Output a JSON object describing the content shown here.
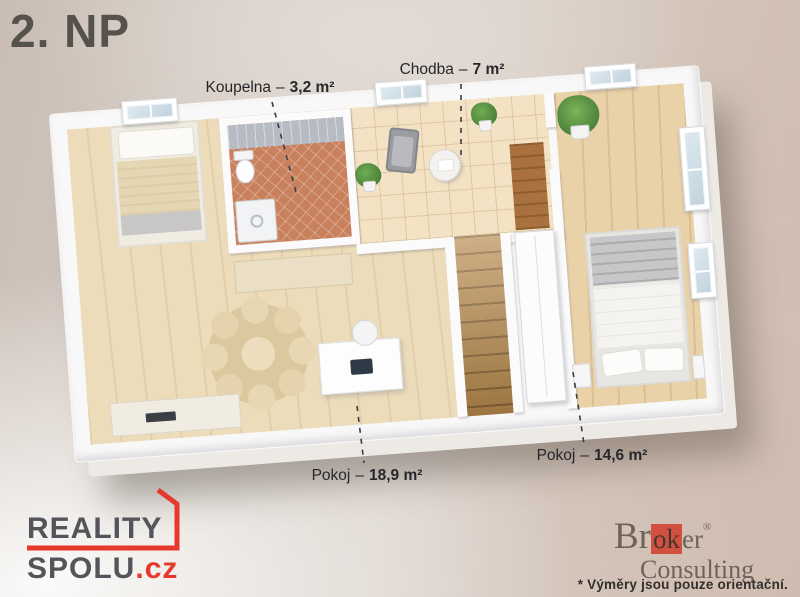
{
  "title": "2. NP",
  "rooms": [
    {
      "name": "Koupelna",
      "sep": "–",
      "area": "3,2 m²"
    },
    {
      "name": "Chodba",
      "sep": "–",
      "area": "7 m²"
    },
    {
      "name": "Pokoj",
      "sep": "–",
      "area": "18,9 m²"
    },
    {
      "name": "Pokoj",
      "sep": "–",
      "area": "14,6 m²"
    }
  ],
  "logos": {
    "reality_spolu": {
      "line1": "REALITY",
      "line2": "SPOLU",
      "tld": ".cz"
    },
    "broker_consulting": {
      "name_prefix": "Br",
      "name_accent": "ok",
      "name_suffix": "er",
      "registered": "®",
      "second_word": "Consulting"
    }
  },
  "disclaimer": "* Výměry jsou pouze orientační.",
  "colors": {
    "accent_red": "#e6382b",
    "logo_gray": "#54555b",
    "broker_red": "#d1503f",
    "broker_text": "#6e635b",
    "label_text": "#26262b",
    "title_text": "#55514b",
    "wall_white": "#f8f8f9",
    "wood_floor": "#ecdcba",
    "hall_tile": "#f3e2c4",
    "bath_tile": "#c9805c"
  }
}
